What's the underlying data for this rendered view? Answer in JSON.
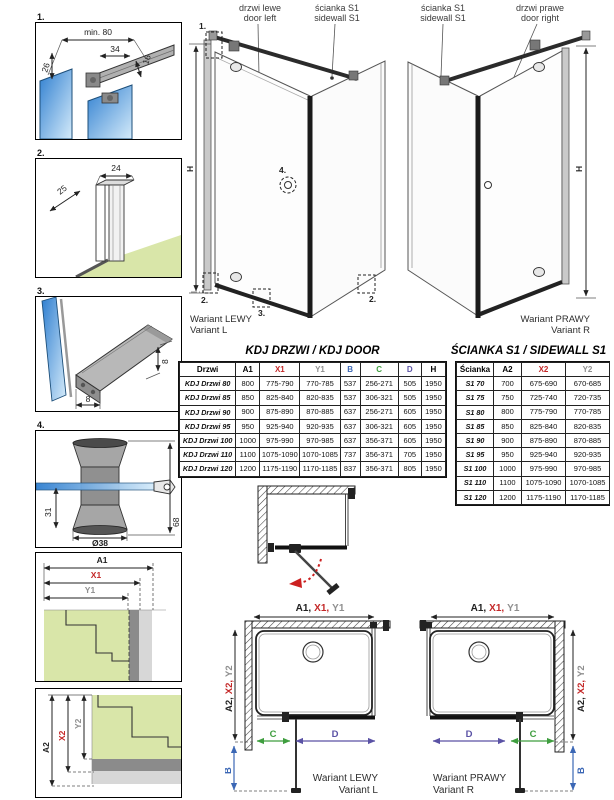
{
  "colors": {
    "red": "#c42828",
    "gray": "#8f8f8f",
    "blue": "#3b67b5",
    "green": "#3f9e3f",
    "purple": "#5a52a5",
    "floor_green": "#d9e6a9",
    "glass_blue": "#2f7fd0"
  },
  "panels": {
    "p1": {
      "num": "1.",
      "min80": "min. 80",
      "d34": "34",
      "d16": "16",
      "d26": "26"
    },
    "p2": {
      "num": "2.",
      "d25": "25",
      "d24": "24"
    },
    "p3": {
      "num": "3.",
      "d8w": "8",
      "d8h": "8"
    },
    "p4": {
      "num": "4.",
      "d31": "31",
      "d38": "Ø38",
      "d68": "68"
    },
    "p5": {
      "a1": "A1",
      "x1": "X1",
      "y1": "Y1"
    },
    "p6": {
      "a2": "A2",
      "x2": "X2",
      "y2": "Y2"
    }
  },
  "views": {
    "left": {
      "door_label": [
        "drzwi lewe",
        "door left"
      ],
      "wall_label": [
        "ścianka S1",
        "sidewall S1"
      ],
      "h": "H",
      "caption": [
        "Wariant LEWY",
        "Variant L"
      ],
      "markers": {
        "m1": "1.",
        "m2l": "2.",
        "m3": "3.",
        "m2r": "2.",
        "m4": "4."
      }
    },
    "right": {
      "wall_label": [
        "ścianka S1",
        "sidewall S1"
      ],
      "door_label": [
        "drzwi prawe",
        "door right"
      ],
      "h": "H",
      "caption": [
        "Wariant PRAWY",
        "Variant R"
      ]
    }
  },
  "kdj_table": {
    "title": "KDJ DRZWI / KDJ DOOR",
    "headers": [
      {
        "label": "Drzwi",
        "color": "#000000"
      },
      {
        "label": "A1",
        "color": "#000000"
      },
      {
        "label": "X1",
        "color": "#c42828"
      },
      {
        "label": "Y1",
        "color": "#8f8f8f"
      },
      {
        "label": "B",
        "color": "#3b67b5"
      },
      {
        "label": "C",
        "color": "#3f9e3f"
      },
      {
        "label": "D",
        "color": "#5a52a5"
      },
      {
        "label": "H",
        "color": "#000000"
      }
    ],
    "rows": [
      [
        "KDJ Drzwi 80",
        "800",
        "775-790",
        "770-785",
        "537",
        "256-271",
        "505",
        "1950"
      ],
      [
        "KDJ Drzwi 85",
        "850",
        "825-840",
        "820-835",
        "537",
        "306-321",
        "505",
        "1950"
      ],
      [
        "KDJ Drzwi 90",
        "900",
        "875-890",
        "870-885",
        "637",
        "256-271",
        "605",
        "1950"
      ],
      [
        "KDJ Drzwi 95",
        "950",
        "925-940",
        "920-935",
        "637",
        "306-321",
        "605",
        "1950"
      ],
      [
        "KDJ Drzwi 100",
        "1000",
        "975-990",
        "970-985",
        "637",
        "356-371",
        "605",
        "1950"
      ],
      [
        "KDJ Drzwi 110",
        "1100",
        "1075-1090",
        "1070-1085",
        "737",
        "356-371",
        "705",
        "1950"
      ],
      [
        "KDJ Drzwi 120",
        "1200",
        "1175-1190",
        "1170-1185",
        "837",
        "356-371",
        "805",
        "1950"
      ]
    ]
  },
  "s1_table": {
    "title": "ŚCIANKA S1 / SIDEWALL S1",
    "headers": [
      {
        "label": "Ścianka",
        "color": "#000000"
      },
      {
        "label": "A2",
        "color": "#000000"
      },
      {
        "label": "X2",
        "color": "#c42828"
      },
      {
        "label": "Y2",
        "color": "#8f8f8f"
      }
    ],
    "rows": [
      [
        "S1 70",
        "700",
        "675-690",
        "670-685"
      ],
      [
        "S1 75",
        "750",
        "725-740",
        "720-735"
      ],
      [
        "S1 80",
        "800",
        "775-790",
        "770-785"
      ],
      [
        "S1 85",
        "850",
        "825-840",
        "820-835"
      ],
      [
        "S1 90",
        "900",
        "875-890",
        "870-885"
      ],
      [
        "S1 95",
        "950",
        "925-940",
        "920-935"
      ],
      [
        "S1 100",
        "1000",
        "975-990",
        "970-985"
      ],
      [
        "S1 110",
        "1100",
        "1075-1090",
        "1070-1085"
      ],
      [
        "S1 120",
        "1200",
        "1175-1190",
        "1170-1185"
      ]
    ]
  },
  "plans": {
    "left": {
      "top": [
        "A1,",
        "X1,",
        "Y1"
      ],
      "side": [
        "A2,",
        "X2,",
        "Y2"
      ],
      "b": "B",
      "c": "C",
      "d": "D",
      "caption": [
        "Wariant LEWY",
        "Variant L"
      ]
    },
    "right": {
      "top": [
        "A1,",
        "X1,",
        "Y1"
      ],
      "side": [
        "A2,",
        "X2,",
        "Y2"
      ],
      "b": "B",
      "c": "C",
      "d": "D",
      "caption": [
        "Wariant PRAWY",
        "Variant R"
      ]
    }
  }
}
